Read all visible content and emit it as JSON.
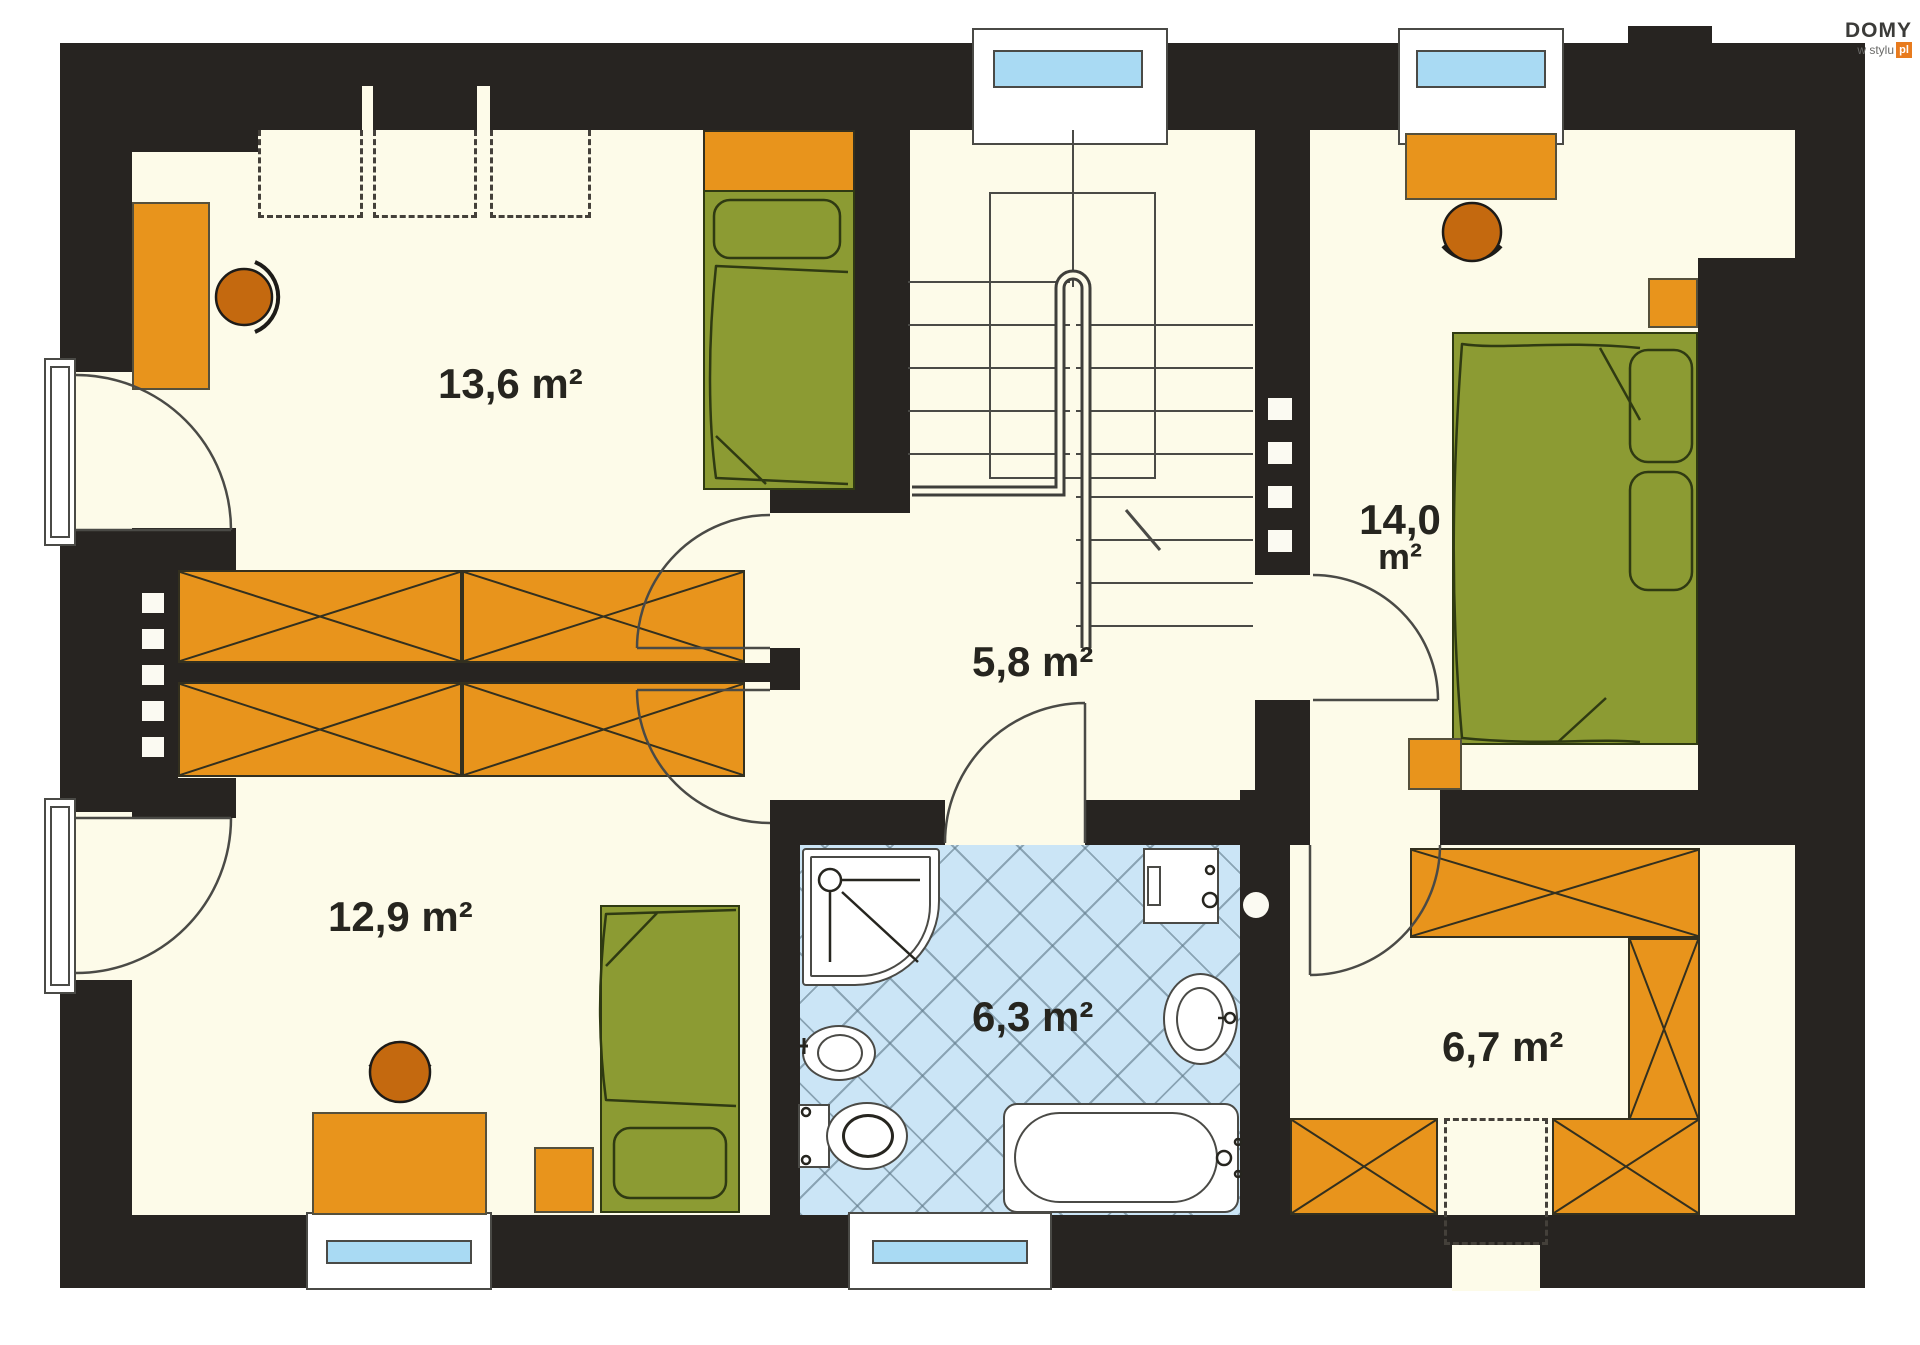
{
  "brand": {
    "name": "DOMY",
    "tagline": "w stylu",
    "suffix": "pl",
    "suffix_bg": "#E87B1E"
  },
  "plan_type": "upper floor plan",
  "rooms": [
    {
      "key": "bedroom-top-left",
      "area": "13,6 m²"
    },
    {
      "key": "bedroom-right",
      "area_value": "14,0",
      "area_unit": "m²"
    },
    {
      "key": "hall-landing",
      "area": "5,8 m²"
    },
    {
      "key": "bedroom-bottom-left",
      "area": "12,9 m²"
    },
    {
      "key": "bathroom",
      "area": "6,3 m²"
    },
    {
      "key": "dressing-room",
      "area": "6,7 m²"
    }
  ],
  "palette": {
    "wall": "#272421",
    "floor": "#FDFBE9",
    "furniture_orange": "#E8941C",
    "chair_orange": "#C4690F",
    "bed_green": "#8C9B33",
    "tile_blue": "#CBE5F6",
    "window_glass_blue": "#A9DAF3",
    "outline": "#4A4A46"
  },
  "symbols": [
    "single-bed",
    "double-bed",
    "desk",
    "office-chair",
    "wardrobe-crossed",
    "dashed-storage",
    "nightstand",
    "stool",
    "staircase",
    "railing",
    "knee-wall",
    "shower",
    "washing-machine",
    "bidet",
    "toilet",
    "washbasin",
    "bathtub",
    "window",
    "door-swing",
    "chimney"
  ]
}
